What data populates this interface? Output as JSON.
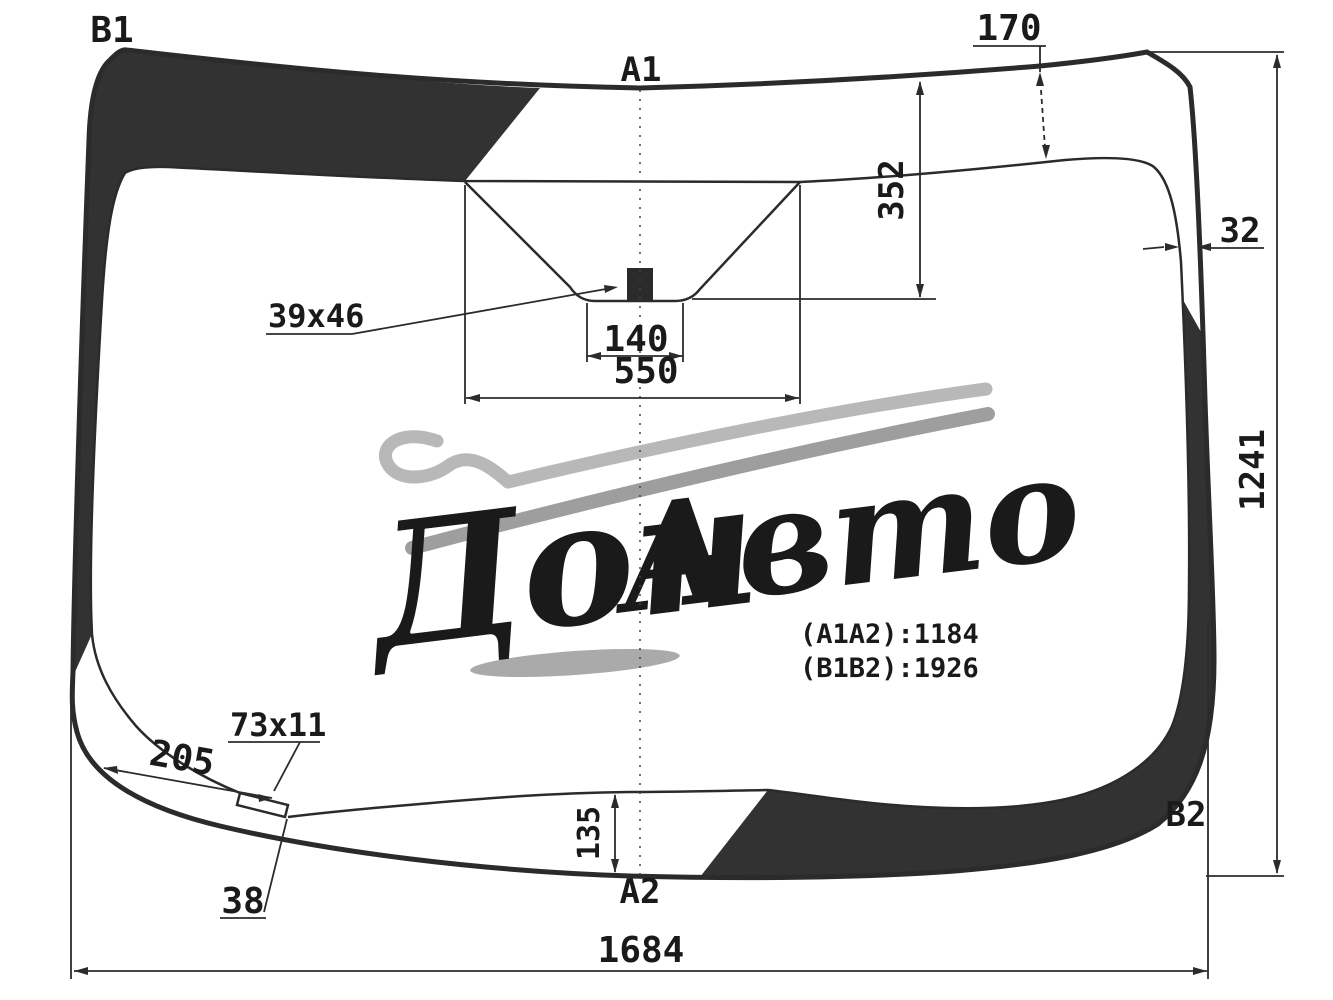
{
  "labels": {
    "b1": "B1",
    "a1": "A1",
    "a2": "A2",
    "b2": "B2"
  },
  "dimensions": {
    "top_band_width": "170",
    "sensor_offset_top": "352",
    "side_band_width": "32",
    "glass_height": "1241",
    "mirror_button_size": "39x46",
    "sensor_opening_width": "140",
    "sensor_area_width": "550",
    "bottom_left_band_length": "205",
    "notch_size": "73x11",
    "notch_leader": "38",
    "bottom_band_width": "135",
    "glass_width": "1684"
  },
  "measurements": {
    "a1a2": "(A1A2):1184",
    "b1b2": "(B1B2):1926"
  },
  "watermark": {
    "word1": "Дон",
    "word2": "Авто"
  },
  "colors": {
    "line": "#2b2b2b",
    "band_fill": "#323232",
    "watermark_light": "#b8b8b8",
    "watermark_mid": "#9e9e9e",
    "watermark_text": "#8f8f8f"
  }
}
